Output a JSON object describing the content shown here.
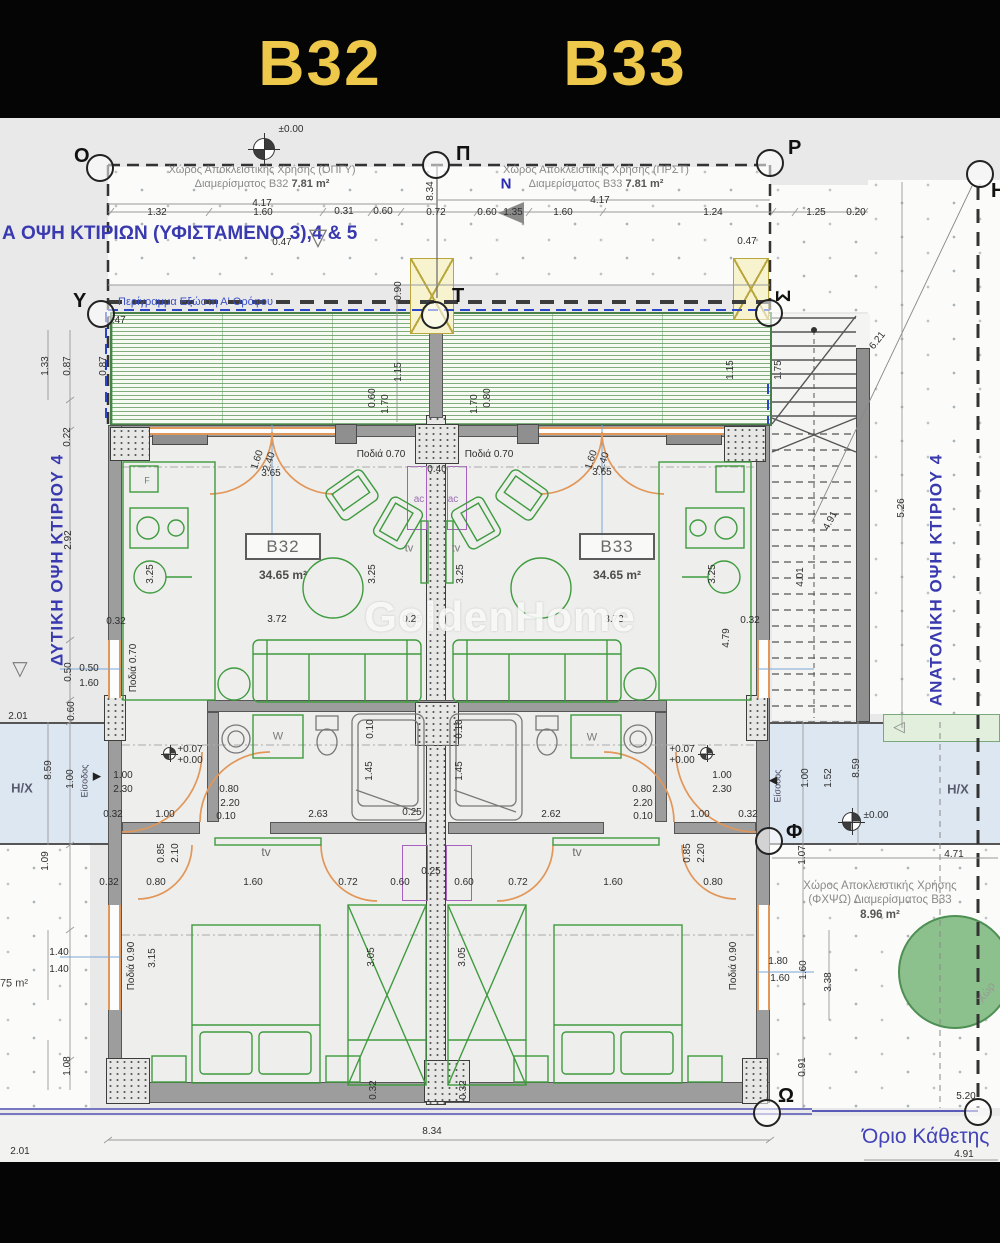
{
  "header": {
    "unit_left": "B32",
    "unit_right": "B33"
  },
  "notes": {
    "excl_tl_1": "Χώρος Αποκλειστικής Χρήσης (ΟΠΓΥ)",
    "excl_tl_2": "Διαμερίσματος Β32",
    "excl_tl_area": "7.81 m²",
    "excl_tr_1": "Χώρος Αποκλειστικής Χρήσης (ΠΡΣΤ)",
    "excl_tr_2": "Διαμερίσματος Β33",
    "excl_tr_area": "7.81 m²",
    "elevation": "Α ΟΨΗ ΚΤΙΡΙΩΝ (ΥΦΙΣΤΑΜΕΝΟ 3),4 & 5",
    "balcony_outline": "Περίγραμμα Εξώστη Α' Ορόφου",
    "west_elevation": "ΔΥΤΙΚΗ ΟΨΗ ΚΤΙΡΙΟΥ 4",
    "east_elevation": "ΑΝΑΤΟΛΙΚΗ ΟΨΗ ΚΤΙΡΙΟΥ 4",
    "boundary": "Όριο Κάθετης",
    "excl_br_1": "Χώρος Αποκλειστικής Χρήσης",
    "excl_br_2": "(ΦΧΨΩ) Διαμερίσματος Β33",
    "excl_br_area": "8.96 m²",
    "watermark": "GoldenHome"
  },
  "rooms": {
    "b32_label": "B32",
    "b32_area": "34.65 m²",
    "b33_label": "B33",
    "b33_area": "34.65 m²"
  },
  "grid_points": [
    [
      "Ο",
      100,
      168,
      74,
      146,
      0
    ],
    [
      "Π",
      436,
      165,
      456,
      144,
      0
    ],
    [
      "Ρ",
      770,
      163,
      788,
      138,
      0
    ],
    [
      "Υ",
      101,
      314,
      73,
      291,
      0
    ],
    [
      "Τ",
      435,
      315,
      452,
      286,
      0
    ],
    [
      "Σ",
      769,
      313,
      778,
      286,
      -90
    ],
    [
      "Η",
      980,
      174,
      991,
      181,
      0
    ],
    [
      "Φ",
      769,
      841,
      786,
      822,
      0
    ],
    [
      "Ω",
      767,
      1113,
      778,
      1086,
      0
    ],
    [
      "",
      978,
      1112,
      0,
      0,
      0
    ]
  ],
  "dims": [
    [
      "±0.00",
      291,
      130,
      0
    ],
    [
      "4.17",
      262,
      204,
      0
    ],
    [
      "4.17",
      600,
      201,
      0
    ],
    [
      "1.32",
      157,
      213,
      0
    ],
    [
      "1.60",
      263,
      213,
      0
    ],
    [
      "0.31",
      344,
      212,
      0
    ],
    [
      "0.60",
      383,
      212,
      0
    ],
    [
      "0.72",
      436,
      213,
      0
    ],
    [
      "0.60",
      487,
      213,
      0
    ],
    [
      "1.35",
      513,
      213,
      0
    ],
    [
      "1.60",
      563,
      213,
      0
    ],
    [
      "1.24",
      713,
      213,
      0
    ],
    [
      "1.25",
      816,
      213,
      0
    ],
    [
      "0.20",
      856,
      213,
      0
    ],
    [
      "0.47",
      282,
      243,
      0
    ],
    [
      "0.47",
      747,
      242,
      0
    ],
    [
      "8.34",
      431,
      191,
      -90
    ],
    [
      "6.21",
      878,
      341,
      -52
    ],
    [
      "1.33",
      46,
      366,
      -90
    ],
    [
      "0.87",
      68,
      366,
      -90
    ],
    [
      "0.87",
      104,
      366,
      -90
    ],
    [
      "0.47",
      116,
      321,
      0
    ],
    [
      "0.22",
      68,
      437,
      -90
    ],
    [
      "0.90",
      399,
      291,
      -90
    ],
    [
      "1.15",
      399,
      372,
      -90
    ],
    [
      "1.15",
      731,
      370,
      -90
    ],
    [
      "1.75",
      779,
      370,
      -90
    ],
    [
      "0.60",
      373,
      398,
      -90
    ],
    [
      "1.70",
      386,
      404,
      -90
    ],
    [
      "0.80",
      488,
      398,
      -90
    ],
    [
      "1.70",
      475,
      404,
      -90
    ],
    [
      "1.60",
      258,
      460,
      -72
    ],
    [
      "2.40",
      270,
      462,
      -72
    ],
    [
      "1.60",
      592,
      460,
      -72
    ],
    [
      "2.40",
      604,
      462,
      -72
    ],
    [
      "3.65",
      271,
      474,
      0
    ],
    [
      "3.65",
      602,
      473,
      0
    ],
    [
      "Ποδιά 0.70",
      381,
      455,
      0
    ],
    [
      "Ποδιά 0.70",
      489,
      455,
      0
    ],
    [
      "0.40",
      437,
      470,
      0
    ],
    [
      "3.25",
      151,
      574,
      -90
    ],
    [
      "3.25",
      373,
      574,
      -90
    ],
    [
      "3.25",
      461,
      574,
      -90
    ],
    [
      "3.25",
      713,
      574,
      -90
    ],
    [
      "3.72",
      277,
      620,
      0
    ],
    [
      "0.25",
      412,
      620,
      0
    ],
    [
      "3.73",
      614,
      620,
      0
    ],
    [
      "0.32",
      116,
      622,
      0
    ],
    [
      "0.32",
      750,
      621,
      0
    ],
    [
      "4.79",
      727,
      638,
      -90
    ],
    [
      "4.01",
      801,
      577,
      -90
    ],
    [
      "4.91",
      831,
      521,
      -62
    ],
    [
      "5.26",
      902,
      508,
      -90
    ],
    [
      "2.92",
      69,
      540,
      -90
    ],
    [
      "0.50",
      69,
      672,
      -90
    ],
    [
      "0.50",
      89,
      669,
      0
    ],
    [
      "1.60",
      89,
      684,
      0
    ],
    [
      "0.60",
      72,
      711,
      -90
    ],
    [
      "2.01",
      18,
      717,
      0
    ],
    [
      "8.59",
      49,
      770,
      -90
    ],
    [
      "1.00",
      71,
      779,
      -90
    ],
    [
      "Ποδιά 0.70",
      134,
      668,
      -90
    ],
    [
      "Ποδιά 0.90",
      132,
      966,
      -90
    ],
    [
      "Ποδιά 0.90",
      734,
      966,
      -90
    ],
    [
      "+0.07",
      190,
      750,
      0
    ],
    [
      "+0.00",
      190,
      761,
      0
    ],
    [
      "+0.07",
      682,
      750,
      0
    ],
    [
      "+0.00",
      682,
      761,
      0
    ],
    [
      "1.00",
      123,
      776,
      0
    ],
    [
      "2.30",
      123,
      790,
      0
    ],
    [
      "1.00",
      722,
      776,
      0
    ],
    [
      "2.30",
      722,
      790,
      0
    ],
    [
      "0.80",
      229,
      790,
      0
    ],
    [
      "2.20",
      230,
      804,
      0
    ],
    [
      "0.10",
      226,
      817,
      0
    ],
    [
      "0.80",
      642,
      790,
      0
    ],
    [
      "2.20",
      643,
      804,
      0
    ],
    [
      "0.10",
      643,
      817,
      0
    ],
    [
      "0.10",
      371,
      729,
      -90
    ],
    [
      "0.10",
      460,
      729,
      -90
    ],
    [
      "1.45",
      370,
      771,
      -90
    ],
    [
      "1.45",
      460,
      771,
      -90
    ],
    [
      "0.32",
      113,
      815,
      0
    ],
    [
      "1.00",
      165,
      815,
      0
    ],
    [
      "2.63",
      318,
      815,
      0
    ],
    [
      "0.25",
      412,
      813,
      0
    ],
    [
      "2.62",
      551,
      815,
      0
    ],
    [
      "1.00",
      700,
      815,
      0
    ],
    [
      "0.32",
      748,
      815,
      0
    ],
    [
      "0.85",
      162,
      853,
      -90
    ],
    [
      "2.10",
      176,
      853,
      -90
    ],
    [
      "0.85",
      688,
      853,
      -90
    ],
    [
      "2.20",
      702,
      853,
      -90
    ],
    [
      "0.32",
      109,
      883,
      0
    ],
    [
      "0.80",
      156,
      883,
      0
    ],
    [
      "1.60",
      253,
      883,
      0
    ],
    [
      "0.72",
      348,
      883,
      0
    ],
    [
      "0.60",
      400,
      883,
      0
    ],
    [
      "0.25",
      431,
      872,
      0
    ],
    [
      "0.60",
      464,
      883,
      0
    ],
    [
      "0.72",
      518,
      883,
      0
    ],
    [
      "1.60",
      613,
      883,
      0
    ],
    [
      "0.80",
      713,
      883,
      0
    ],
    [
      "1.09",
      46,
      861,
      -90
    ],
    [
      "1.40",
      59,
      953,
      0
    ],
    [
      "1.40",
      59,
      970,
      0
    ],
    [
      "3.15",
      153,
      958,
      -90
    ],
    [
      "3.05",
      372,
      957,
      -90
    ],
    [
      "3.05",
      463,
      957,
      -90
    ],
    [
      "1.80",
      778,
      962,
      0
    ],
    [
      "1.60",
      780,
      979,
      0
    ],
    [
      "1.60",
      804,
      970,
      -90
    ],
    [
      "3.38",
      829,
      982,
      -90
    ],
    [
      "1.07",
      803,
      855,
      -90
    ],
    [
      "4.71",
      954,
      855,
      0
    ],
    [
      "0.91",
      803,
      1067,
      -90
    ],
    [
      "1.00",
      806,
      778,
      -90
    ],
    [
      "1.52",
      829,
      778,
      -90
    ],
    [
      "8.59",
      857,
      768,
      -90
    ],
    [
      "±0.00",
      876,
      816,
      0
    ],
    [
      "1.08",
      68,
      1066,
      -90
    ],
    [
      "0.32",
      374,
      1090,
      -90
    ],
    [
      "0.32",
      464,
      1090,
      -90
    ],
    [
      "5.20",
      966,
      1097,
      0
    ],
    [
      "8.34",
      432,
      1132,
      0
    ],
    [
      "4.91",
      964,
      1155,
      0
    ],
    [
      "2.01",
      20,
      1152,
      0
    ]
  ],
  "labels": [
    [
      "tv",
      409,
      549,
      11,
      "#787878",
      0,
      0
    ],
    [
      "tv",
      456,
      549,
      11,
      "#787878",
      0,
      0
    ],
    [
      "tv",
      266,
      852,
      12,
      "#6a6a6a",
      0,
      0
    ],
    [
      "tv",
      577,
      852,
      12,
      "#6a6a6a",
      0,
      0
    ],
    [
      "W",
      278,
      737,
      11,
      "#7a7a7a",
      0,
      0
    ],
    [
      "W",
      592,
      738,
      11,
      "#7a7a7a",
      0,
      0
    ],
    [
      "ac",
      419,
      500,
      10,
      "#9a6fb0",
      0,
      0
    ],
    [
      "ac",
      453,
      500,
      10,
      "#9a6fb0",
      0,
      0
    ],
    [
      "F",
      147,
      481,
      9,
      "#668866",
      0,
      0
    ],
    [
      "Η/Χ",
      22,
      788,
      13,
      "#5a5a6e",
      0,
      1
    ],
    [
      "Η/Χ",
      958,
      789,
      13,
      "#5a5a6e",
      0,
      1
    ],
    [
      "Είσοδος",
      85,
      781,
      9,
      "#44445a",
      -90,
      0
    ],
    [
      "Είσοδος",
      778,
      786,
      9,
      "#44445a",
      -90,
      0
    ],
    [
      "▶",
      97,
      777,
      11,
      "#222222",
      0,
      0
    ],
    [
      "◀",
      773,
      781,
      11,
      "#222222",
      0,
      0
    ],
    [
      "▽",
      318,
      238,
      24,
      "#777777",
      0,
      0
    ],
    [
      "▽",
      20,
      669,
      20,
      "#777777",
      0,
      0
    ],
    [
      "◁",
      899,
      727,
      15,
      "#888888",
      0,
      0
    ],
    [
      "N",
      506,
      184,
      15,
      "#2a2ab0",
      0,
      1
    ],
    [
      "Χώρ",
      987,
      993,
      11,
      "#999999",
      -55,
      0
    ],
    [
      "75 m²",
      14,
      984,
      11,
      "#444444",
      0,
      0
    ]
  ],
  "colors": {
    "header_text": "#eec84a",
    "blue_note": "#3a3ab0",
    "furniture_green": "#3f9b3f",
    "door_orange": "#e2975a",
    "walkway_blue": "#dde7f2",
    "boundary_purple": "#7878c0",
    "tree_green": "#8cc08c",
    "deck_green": "#559655",
    "wall_gray": "#9d9d9d"
  }
}
